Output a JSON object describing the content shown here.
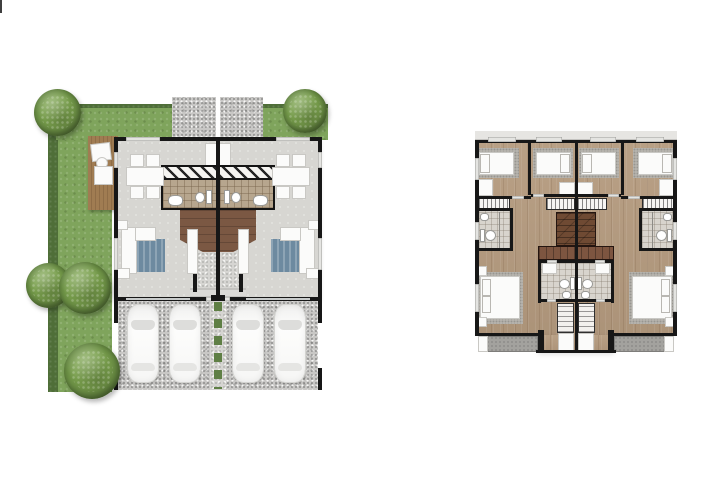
{
  "document": {
    "type": "architectural floor plan rendering",
    "visible_text": [],
    "plans": [
      {
        "id": "ground-floor-plan",
        "label": "Ground floor of a twin duplex: wrap-around lawn with trees, timber deck, per-unit dining area, central bathrooms, stair foyer, living room with sofa and TV, entry porch and a gravel double carport with two cars per unit"
      },
      {
        "id": "upper-floor-plan",
        "label": "Upper floor of the twin duplex: two single bedrooms per unit with wardrobes and desks, side bathrooms, central staircase, master bedroom with en-suite bathroom, walk-in closet and balcony per unit"
      }
    ],
    "counts": {
      "units": 2,
      "trees": 5,
      "cars": 4,
      "bedrooms_per_unit": 3,
      "balconies": 2
    }
  },
  "colors": {
    "grass": "#7fa45c",
    "grassDark": "#4f6e38",
    "treeMid": "#7ba24e",
    "treeDark": "#44612c",
    "gravel": "#c8c7c5",
    "gravelLight": "#d6d5d2",
    "deckWood": "#8f6d47",
    "deckWoodLight": "#a07c52",
    "floorGray": "#d7d6d2",
    "wallDark": "#171717",
    "tileTan": "#b7a68e",
    "tileLight": "#d8d4cd",
    "brownStair": "#6f4a33",
    "brownLanding": "#7d5540",
    "brownFoyer": "#7b5843",
    "wood": "#b59b7f",
    "rugGray": "#b5b2ac",
    "rugBlue": "#6d8aa0",
    "balconyGray": "#a3a29e",
    "fixtureWhite": "#fbfbfa",
    "greenStrip": "#5f7f45",
    "roofBand": "#e6e5e2",
    "glass": "#c8cbcb"
  },
  "sprites": [
    {
      "cls": "artifact",
      "name": "scrollbar-artifact",
      "parent": "canvas",
      "x": 1,
      "y": 0,
      "w": 2,
      "h": 13
    },
    {
      "cls": "tree",
      "name": "tree",
      "parent": "ground-plan",
      "x": 34,
      "y": 89,
      "w": 47,
      "h": 47
    },
    {
      "cls": "tree",
      "name": "tree",
      "parent": "ground-plan",
      "x": 283,
      "y": 89,
      "w": 44,
      "h": 44
    },
    {
      "cls": "tree",
      "name": "tree",
      "parent": "ground-plan",
      "x": 26,
      "y": 263,
      "w": 45,
      "h": 45
    },
    {
      "cls": "tree",
      "name": "tree",
      "parent": "ground-plan",
      "x": 59,
      "y": 262,
      "w": 52,
      "h": 52
    },
    {
      "cls": "tree",
      "name": "tree",
      "parent": "ground-plan",
      "x": 64,
      "y": 343,
      "w": 56,
      "h": 56
    },
    {
      "cls": "car",
      "name": "car",
      "parent": "ground-plan",
      "x": 128,
      "y": 305,
      "w": 30,
      "h": 77
    },
    {
      "cls": "car",
      "name": "car",
      "parent": "ground-plan",
      "x": 170,
      "y": 305,
      "w": 30,
      "h": 77
    },
    {
      "cls": "car",
      "name": "car",
      "parent": "ground-plan",
      "x": 233,
      "y": 305,
      "w": 30,
      "h": 77
    },
    {
      "cls": "car",
      "name": "car",
      "parent": "ground-plan",
      "x": 275,
      "y": 305,
      "w": 30,
      "h": 77
    }
  ]
}
